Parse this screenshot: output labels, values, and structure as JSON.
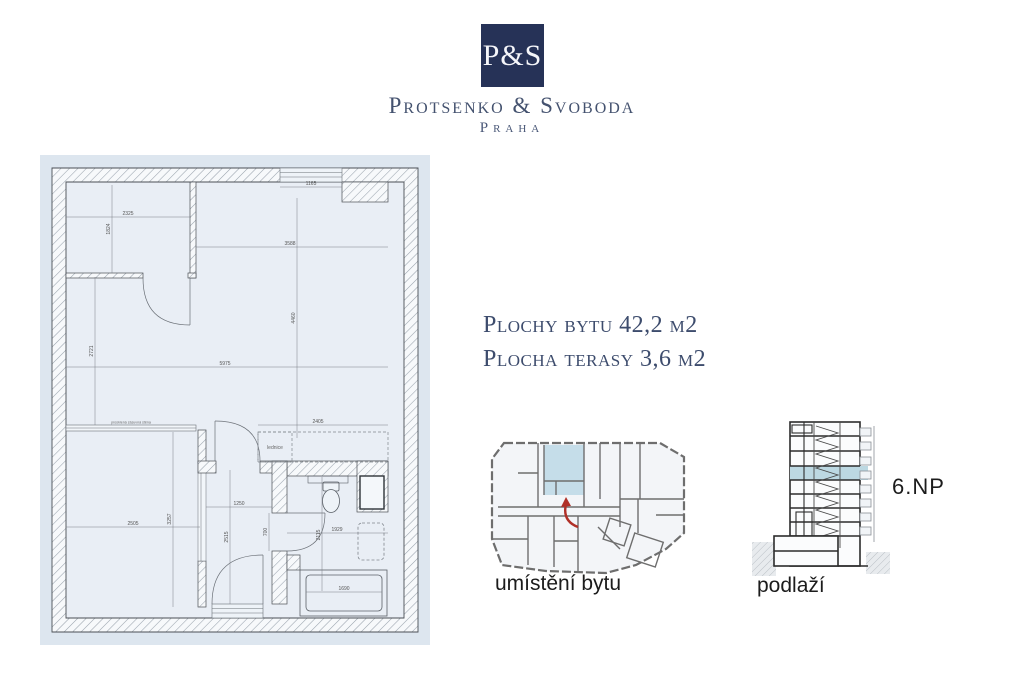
{
  "brand": {
    "logo_text": "P&S",
    "name": "Protsenko & Svoboda",
    "city": "Praha"
  },
  "summary": {
    "line1": "Plochy bytu 42,2 m2",
    "line2": "Plocha terasy 3,6 m2"
  },
  "plan": {
    "labels": {
      "fridge": "lednice",
      "glass_wall": "prosklená zásuvná stěna"
    },
    "dims": {
      "top_window": "1165",
      "tl_room_w": "2325",
      "tl_room_h": "1824",
      "main_w": "3588",
      "main_h": "4460",
      "living_w": "5975",
      "living_h": "2721",
      "kitchen_w": "2405",
      "bedroom_w": "2505",
      "bedroom_h": "3257",
      "hall_w": "1250",
      "hall_h": "2515",
      "bath_door": "700",
      "bath_w": "1929",
      "bath_h": "2115",
      "tub_w": "1690"
    }
  },
  "location": {
    "caption": "umístění bytu"
  },
  "section": {
    "caption": "podlaží",
    "floor": "6.NP"
  },
  "colors": {
    "brand_navy": "#263257",
    "panel_bg": "#dde6ef",
    "unit_highlight": "#c5dde9",
    "arrow_red": "#b03028"
  }
}
